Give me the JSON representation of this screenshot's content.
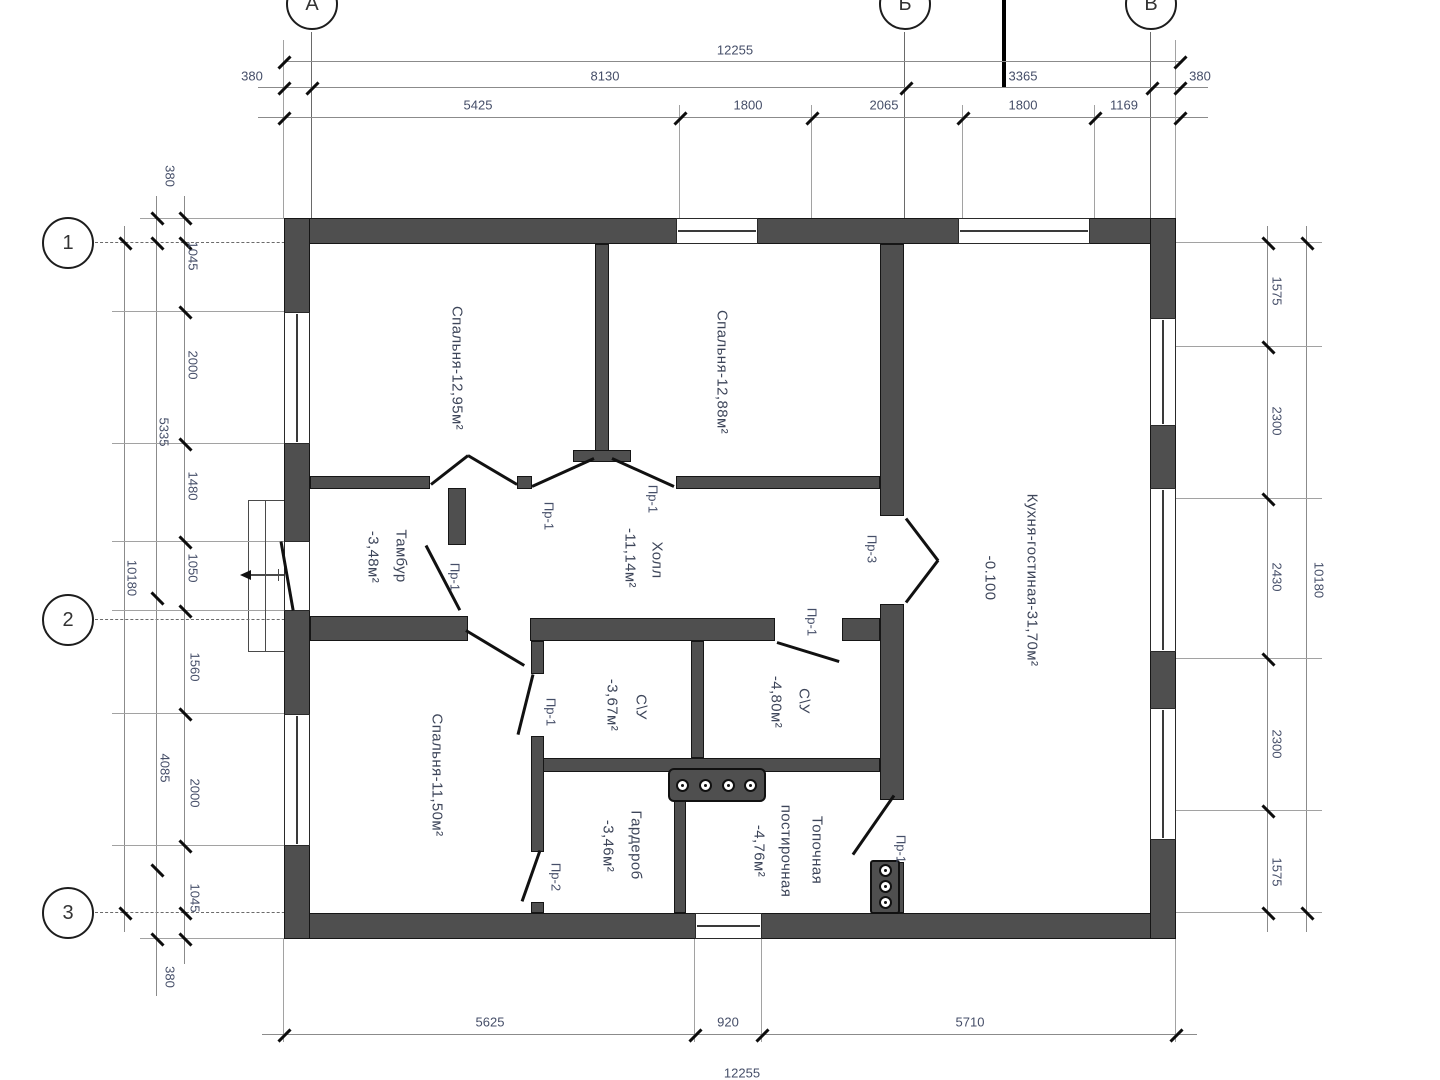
{
  "drawing": {
    "type": "floor-plan",
    "wall_color": "#4f4f4f",
    "dim_text_color": "#454e68"
  },
  "axes": {
    "top": {
      "a": "А",
      "b": "Б",
      "v": "В"
    },
    "left": {
      "n1": "1",
      "n2": "2",
      "n3": "3"
    }
  },
  "dims": {
    "top_total": "12255",
    "top_row2": [
      "380",
      "8130",
      "3365",
      "380"
    ],
    "top_row3": [
      "5425",
      "1800",
      "2065",
      "1800",
      "1169"
    ],
    "left_inner": [
      "380",
      "1045",
      "2000",
      "1480",
      "1050",
      "1560",
      "2000",
      "1045",
      "380"
    ],
    "left_mid": [
      "5335",
      "4085"
    ],
    "left_total": "10180",
    "right_inner": [
      "1575",
      "2300",
      "2430",
      "2300",
      "1575"
    ],
    "right_total": "10180",
    "bottom_row": [
      "5625",
      "920",
      "5710"
    ],
    "bottom_total": "12255"
  },
  "rooms": {
    "bedroom1": "Спальня-12,95м²",
    "bedroom2": "Спальня-12,88м²",
    "kitchen": "Кухня-гостиная-31,70м²",
    "kitchen_level": "-0.100",
    "hall_name": "Холл",
    "hall_area": "-11,14м²",
    "tambour_name": "Тамбур",
    "tambour_area": "-3,48м²",
    "wc1_name": "С\\У",
    "wc1_area": "-3,67м²",
    "wc2_name": "С\\У",
    "wc2_area": "-4,80м²",
    "bedroom3": "Спальня-11,50м²",
    "wardrobe_name": "Гардероб",
    "wardrobe_area": "-3,46м²",
    "utility_name": "Топочная",
    "utility_name2": "постирочная",
    "utility_area": "-4,76м²"
  },
  "doors": {
    "pr1_bedroom1": "Пр-1",
    "pr1_bedroom2": "Пр-1",
    "pr1_tambour": "Пр-1",
    "pr1_wc1": "Пр-1",
    "pr1_wc2": "Пр-1",
    "pr1_utility": "Пр-1",
    "pr2_wardrobe": "Пр-2",
    "pr3_kitchen": "Пр-3"
  }
}
